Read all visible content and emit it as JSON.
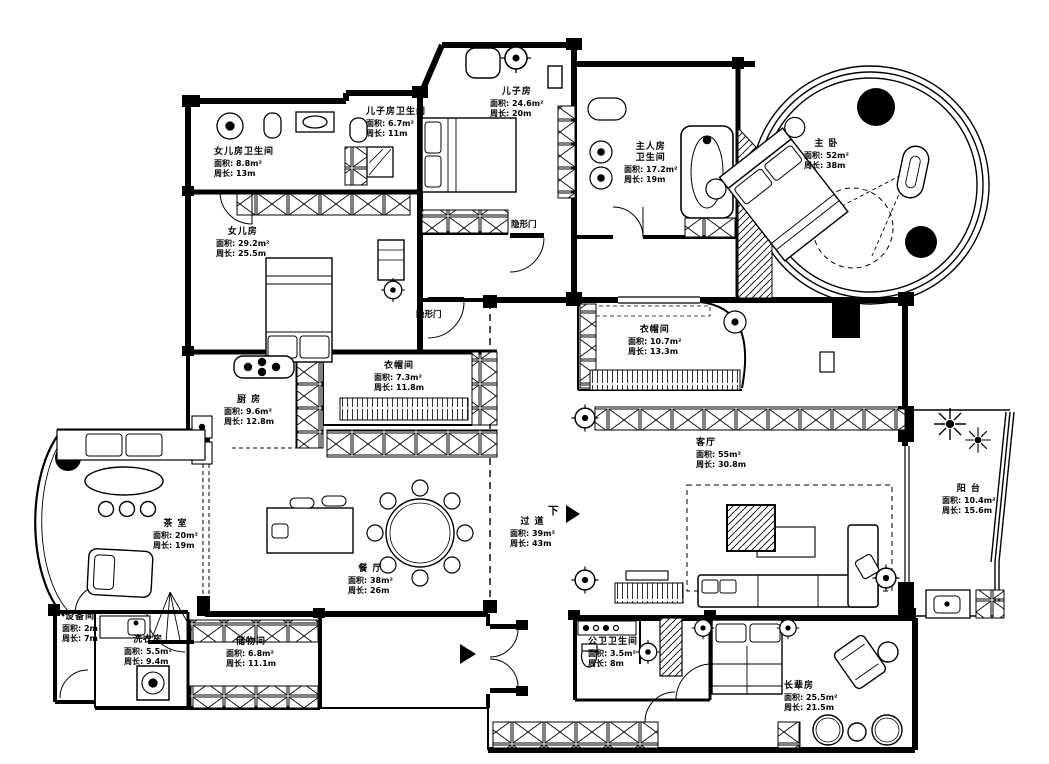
{
  "plan": {
    "title": "apartment-floor-plan",
    "rooms": [
      {
        "id": "daughter-bath",
        "name": "女儿房卫生间",
        "area": "面积: 8.8m²",
        "perimeter": "周长: 13m"
      },
      {
        "id": "son-bath",
        "name": "儿子房卫生间",
        "area": "面积: 6.7m²",
        "perimeter": "周长: 11m"
      },
      {
        "id": "son-room",
        "name": "儿子房",
        "area": "面积: 24.6m²",
        "perimeter": "周长: 20m"
      },
      {
        "id": "master-bath",
        "name": "主人房卫生间",
        "area": "面积: 17.2m²",
        "perimeter": "周长: 19m"
      },
      {
        "id": "master-bedroom",
        "name": "主 卧",
        "area": "面积: 52m²",
        "perimeter": "周长: 38m"
      },
      {
        "id": "daughter-room",
        "name": "女儿房",
        "area": "面积: 29.2m²",
        "perimeter": "周长: 25.5m"
      },
      {
        "id": "cloak-left",
        "name": "衣帽间",
        "area": "面积: 7.3m²",
        "perimeter": "周长: 11.8m"
      },
      {
        "id": "cloak-right",
        "name": "衣帽间",
        "area": "面积: 10.7m²",
        "perimeter": "周长: 13.3m"
      },
      {
        "id": "kitchen",
        "name": "厨 房",
        "area": "面积: 9.6m²",
        "perimeter": "周长: 12.8m"
      },
      {
        "id": "living-room",
        "name": "客厅",
        "area": "面积: 55m²",
        "perimeter": "周长: 30.8m"
      },
      {
        "id": "tea-room",
        "name": "茶 室",
        "area": "面积: 20m²",
        "perimeter": "周长: 19m"
      },
      {
        "id": "balcony",
        "name": "阳 台",
        "area": "面积: 10.4m²",
        "perimeter": "周长: 15.6m"
      },
      {
        "id": "corridor",
        "name": "过 道",
        "area": "面积: 39m²",
        "perimeter": "周长: 43m"
      },
      {
        "id": "dining-room",
        "name": "餐 厅",
        "area": "面积: 38m²",
        "perimeter": "周长: 26m"
      },
      {
        "id": "equipment-room",
        "name": "设备间",
        "area": "面积: 2m",
        "perimeter": "周长: 7m"
      },
      {
        "id": "laundry-room",
        "name": "洗衣房",
        "area": "面积: 5.5m²",
        "perimeter": "周长: 9.4m"
      },
      {
        "id": "storage-room",
        "name": "储物间",
        "area": "面积: 6.8m²",
        "perimeter": "周长: 11.1m"
      },
      {
        "id": "public-bath",
        "name": "公卫卫生间",
        "area": "面积: 3.5m²",
        "perimeter": "周长: 8m"
      },
      {
        "id": "elders-room",
        "name": "长辈房",
        "area": "面积: 25.5m²",
        "perimeter": "周长: 21.5m"
      }
    ],
    "annotations": [
      {
        "id": "hidden-door-1",
        "text": "隐形门"
      },
      {
        "id": "hidden-door-2",
        "text": "隐形门"
      },
      {
        "id": "down-marker",
        "text": "下"
      }
    ],
    "colors": {
      "ink": "#000000",
      "paper": "#ffffff"
    }
  }
}
